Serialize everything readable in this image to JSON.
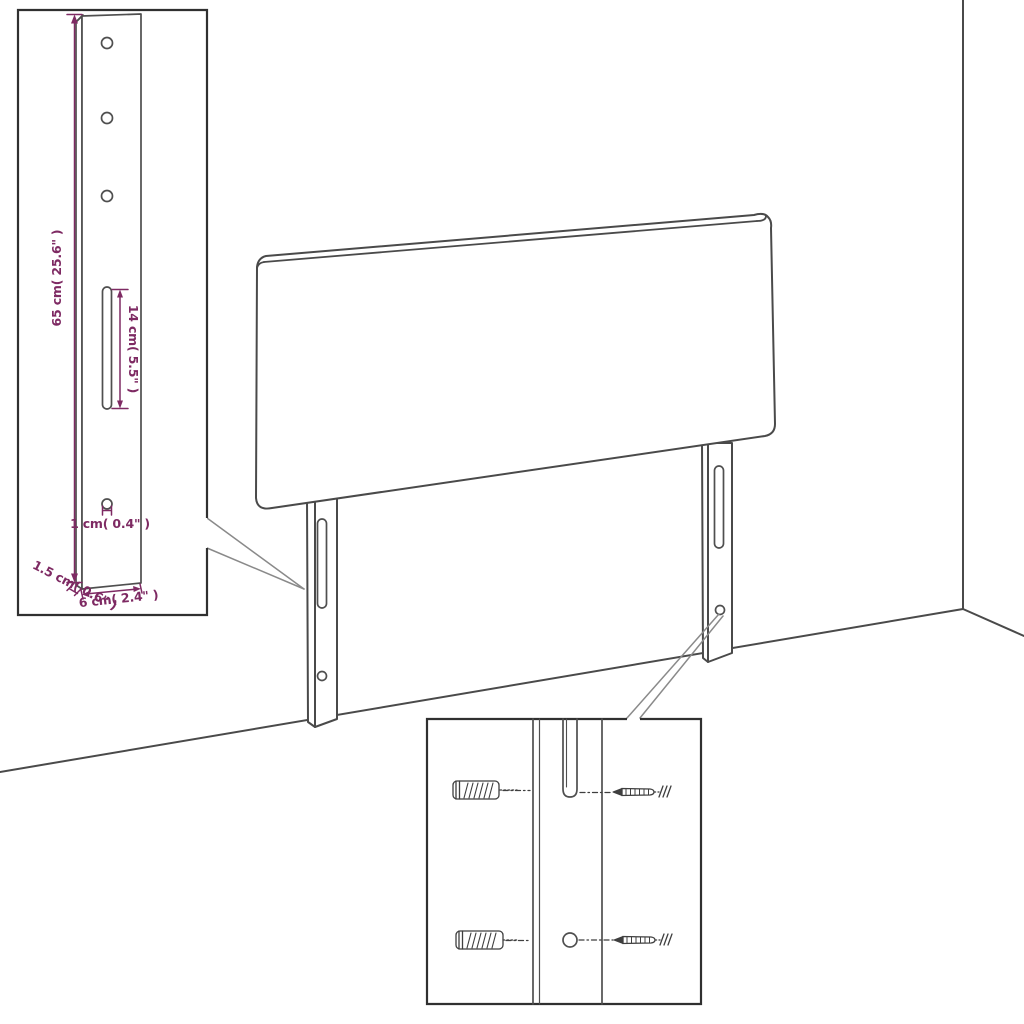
{
  "colors": {
    "background": "#ffffff",
    "line": "#4a4a4a",
    "inset_border": "#303030",
    "dimension": "#7e2a63"
  },
  "diagram": {
    "subject": "upholstered headboard with two slotted mounting legs",
    "scene": "room corner line drawing with wall and floor edges"
  },
  "leg_detail_inset": {
    "dim_height": "65 cm( 25.6\" )",
    "dim_slot": "14 cm( 5.5\" )",
    "dim_hole": "1 cm( 0.4\" )",
    "dim_depth": "1.5 cm( 0.6\" )",
    "dim_width": "6 cm( 2.4\" )"
  },
  "mounting_detail_inset": {
    "parts": [
      "wall-plug",
      "screw",
      "keyhole-slot",
      "screw-hole"
    ]
  }
}
